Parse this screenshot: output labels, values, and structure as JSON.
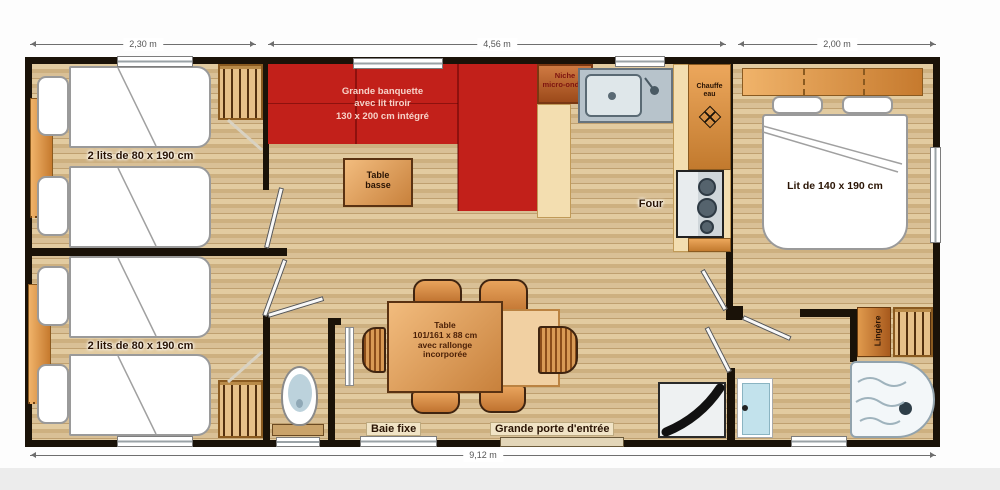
{
  "dimensions": {
    "top_left": "2,30 m",
    "top_center": "4,56 m",
    "top_right": "2,00 m",
    "bottom": "9,12 m"
  },
  "rooms": {
    "bedroom_twin_top": {
      "label": "2 lits de 80 x 190 cm"
    },
    "bedroom_twin_bottom": {
      "label": "2 lits de 80 x 190 cm"
    },
    "living": {
      "sofa": {
        "line1": "Grande banquette",
        "line2": "avec lit tiroir",
        "line3": "130 x 200 cm intégré"
      },
      "coffee_table": {
        "line1": "Table",
        "line2": "basse"
      }
    },
    "kitchen": {
      "microwave_niche": {
        "line1": "Niche",
        "line2": "micro-ondes"
      },
      "water_heater": {
        "line1": "Chauffe",
        "line2": "eau"
      },
      "oven": "Four"
    },
    "dining": {
      "table": {
        "line1": "Table",
        "line2": "101/161 x 88 cm",
        "line3": "avec rallonge",
        "line4": "incorporée"
      }
    },
    "bedroom_double": {
      "label": "Lit de 140 x 190 cm"
    },
    "bathroom": {
      "linen_cabinet": "Lingère"
    },
    "openings": {
      "fixed_bay": "Baie fixe",
      "entry_door": "Grande porte d'entrée"
    }
  },
  "icons": {
    "water_heater_vent": "fan-diamond-icon",
    "wardrobes": "hanger-rack-icon",
    "shower": "shower-tray-icon",
    "toilet": "toilet-icon",
    "sink": "kitchen-sink-icon",
    "hob": "gas-hob-icon",
    "washbasin": "corner-washbasin-icon"
  },
  "colors": {
    "wall": "#1a1208",
    "sofa_red": "#c2201a",
    "wood_light": "#e0c89c",
    "wood_dark": "#bfa070",
    "counter_cream": "#f3deb0",
    "cabinet_orange": "#d98a3e",
    "steel_blue": "#b7c3cb",
    "door_blue": "#c2e2ec"
  }
}
